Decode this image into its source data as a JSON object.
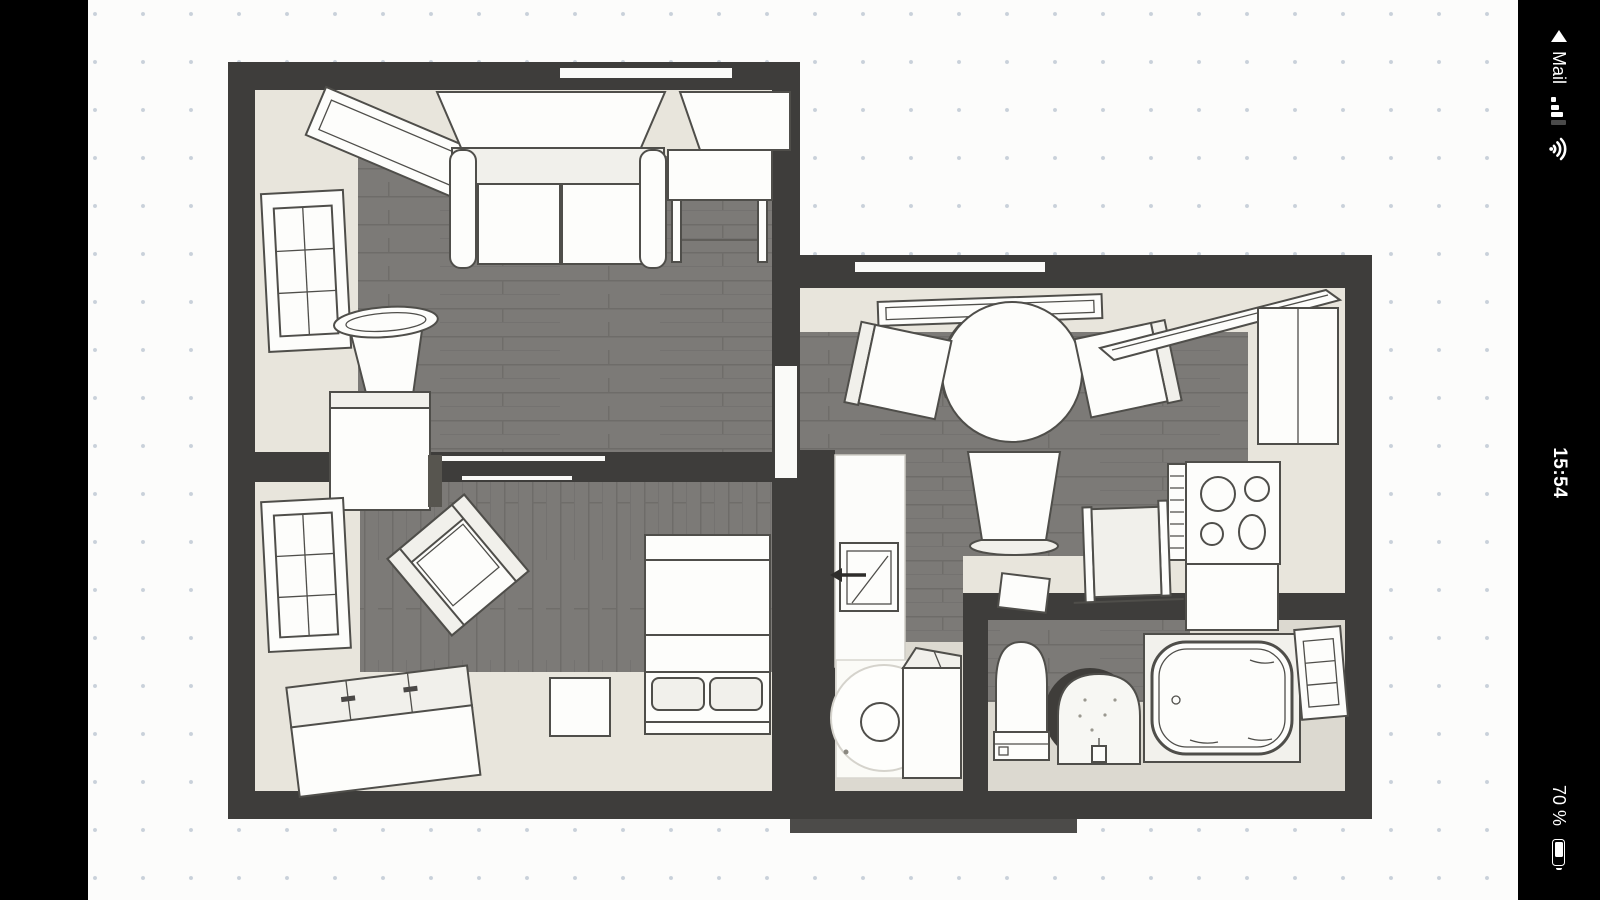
{
  "status_bar": {
    "back_indicator_icon": "return-to-app-triangle",
    "app_label": "Mail",
    "signal_icon": "cellular-signal-3-of-4-bars",
    "wifi_icon": "wifi",
    "time": "15:54",
    "battery_percent": "70 %",
    "battery_icon": "battery-70-percent"
  },
  "floorplan": {
    "type": "apartment-floor-plan-top-view",
    "rooms": [
      {
        "name": "living-room",
        "furniture": [
          "window",
          "wall-shelf",
          "window-front",
          "sofa",
          "corner-table",
          "stool",
          "cabinet"
        ]
      },
      {
        "name": "bedroom",
        "furniture": [
          "window",
          "armchair",
          "dresser",
          "bed-with-pillows",
          "nightstand"
        ]
      },
      {
        "name": "kitchen-dining",
        "furniture": [
          "wall-shelf",
          "round-table",
          "chair-left",
          "chair-right",
          "chair-bottom",
          "tall-cabinet-open-door",
          "cooktop",
          "counter",
          "radiator-panel",
          "small-cabinet"
        ]
      },
      {
        "name": "hallway",
        "furniture": [
          "counter-with-sink",
          "door-swing-arrow",
          "washing-machine",
          "cabinet"
        ]
      },
      {
        "name": "bathroom",
        "furniture": [
          "toilet",
          "round-rug",
          "pedestal-sink",
          "bathtub",
          "window"
        ]
      }
    ]
  },
  "colors": {
    "letterbox": "#000000",
    "canvas_bg": "#fcfcfb",
    "grid_dot": "#c9d1da",
    "wall": "#3e3d3b",
    "wood_floor": "#7c7a77",
    "wood_line": "#6e6c69",
    "wall_face": "#e8e5dc",
    "light_floor": "#dcd9d0",
    "furniture_fill": "#fdfdfb",
    "furniture_outline": "#4f4e4a",
    "status_text": "#ffffff"
  }
}
